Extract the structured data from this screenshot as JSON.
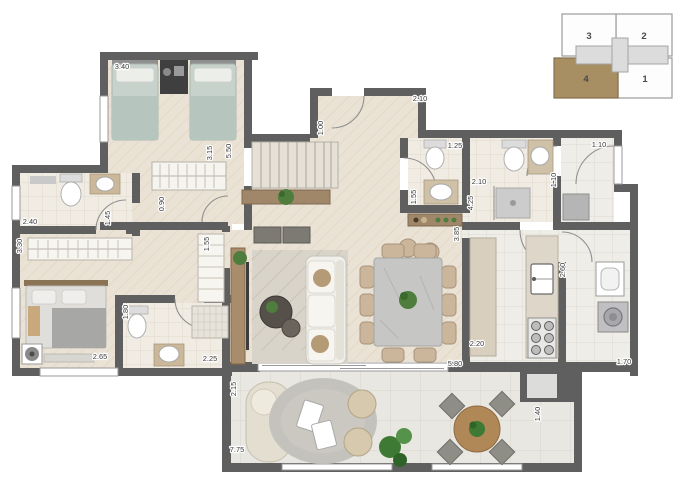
{
  "title": "apartment-floor-plan",
  "colors": {
    "wall": "#5f5f5f",
    "keyplan_highlight": "#a78e63",
    "wood_floor": "#eae2d4",
    "bath_floor": "#f1ece3",
    "balcony_floor": "#e9e7e1"
  },
  "key_plan": {
    "units": [
      {
        "label": "3",
        "x": 562,
        "y": 14,
        "w": 54,
        "h": 42,
        "fill": "#fdfdfd",
        "stroke": "#9b9b9b",
        "label_color": "#4a4a4a"
      },
      {
        "label": "2",
        "x": 616,
        "y": 14,
        "w": 56,
        "h": 42,
        "fill": "#fdfdfd",
        "stroke": "#9b9b9b",
        "label_color": "#4a4a4a"
      },
      {
        "label": "4",
        "x": 554,
        "y": 58,
        "w": 64,
        "h": 40,
        "fill": "#a78e63",
        "stroke": "#86704c",
        "label_color": "#332a18"
      },
      {
        "label": "1",
        "x": 618,
        "y": 58,
        "w": 54,
        "h": 40,
        "fill": "#fdfdfd",
        "stroke": "#9b9b9b",
        "label_color": "#4a4a4a"
      }
    ]
  },
  "dimension_labels": [
    {
      "text": "3.40",
      "x": 122,
      "y": 69,
      "orientation": "h"
    },
    {
      "text": "2.10",
      "x": 420,
      "y": 101,
      "orientation": "h"
    },
    {
      "text": "1.00",
      "x": 323,
      "y": 128,
      "orientation": "v"
    },
    {
      "text": "3.15",
      "x": 212,
      "y": 153,
      "orientation": "v"
    },
    {
      "text": "5.50",
      "x": 231,
      "y": 151,
      "orientation": "v"
    },
    {
      "text": "2.40",
      "x": 30,
      "y": 224,
      "orientation": "h"
    },
    {
      "text": "1.45",
      "x": 110,
      "y": 218,
      "orientation": "v"
    },
    {
      "text": "3.30",
      "x": 22,
      "y": 246,
      "orientation": "v"
    },
    {
      "text": "0.90",
      "x": 164,
      "y": 204,
      "orientation": "v"
    },
    {
      "text": "1.55",
      "x": 209,
      "y": 244,
      "orientation": "v"
    },
    {
      "text": "1.25",
      "x": 455,
      "y": 148,
      "orientation": "h"
    },
    {
      "text": "1.55",
      "x": 416,
      "y": 197,
      "orientation": "v"
    },
    {
      "text": "2.10",
      "x": 479,
      "y": 184,
      "orientation": "h"
    },
    {
      "text": "4.25",
      "x": 473,
      "y": 203,
      "orientation": "v"
    },
    {
      "text": "1.10",
      "x": 556,
      "y": 180,
      "orientation": "v"
    },
    {
      "text": "1.10",
      "x": 599,
      "y": 147,
      "orientation": "h"
    },
    {
      "text": "3.85",
      "x": 459,
      "y": 234,
      "orientation": "v"
    },
    {
      "text": "2.60",
      "x": 565,
      "y": 270,
      "orientation": "v"
    },
    {
      "text": "2.65",
      "x": 100,
      "y": 359,
      "orientation": "h"
    },
    {
      "text": "1.80",
      "x": 128,
      "y": 312,
      "orientation": "v"
    },
    {
      "text": "2.25",
      "x": 210,
      "y": 361,
      "orientation": "h"
    },
    {
      "text": "2.15",
      "x": 236,
      "y": 389,
      "orientation": "v"
    },
    {
      "text": "2.20",
      "x": 477,
      "y": 346,
      "orientation": "h"
    },
    {
      "text": "5.80",
      "x": 455,
      "y": 366,
      "orientation": "h"
    },
    {
      "text": "1.70",
      "x": 624,
      "y": 364,
      "orientation": "h"
    },
    {
      "text": "1.40",
      "x": 540,
      "y": 414,
      "orientation": "v"
    },
    {
      "text": "7.75",
      "x": 237,
      "y": 452,
      "orientation": "h"
    }
  ]
}
